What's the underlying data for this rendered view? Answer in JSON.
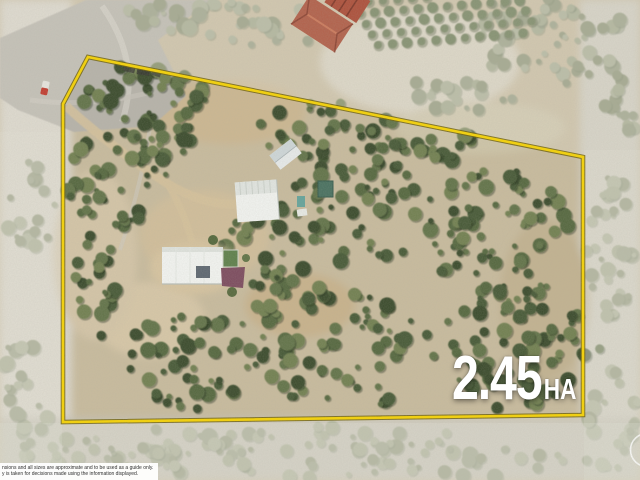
{
  "overlay": {
    "area": {
      "value": "2.45",
      "unit": "HA"
    },
    "disclaimer": {
      "line1": "nsions and all sizes are approximate and to be used as a guide only.",
      "line2": "y is taken for decisions made using the information displayed."
    },
    "boundary_color": "#f8d402",
    "boundary_edge_color": "#6e5f06",
    "label_color": "#ffffff"
  }
}
